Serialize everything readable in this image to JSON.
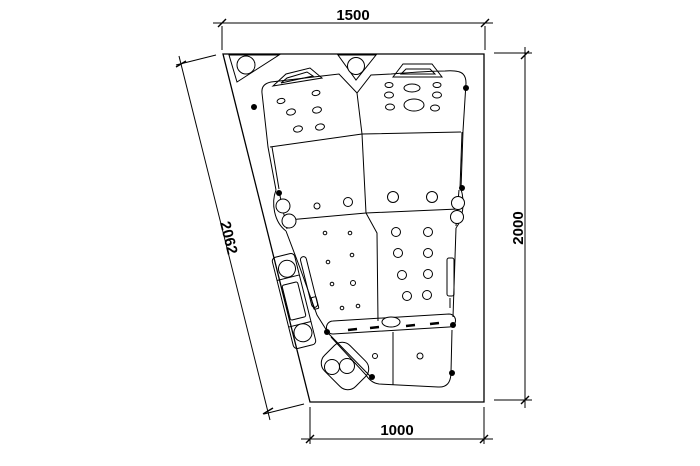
{
  "drawing": {
    "background": "#ffffff",
    "line_color": "#000000",
    "dimensions": {
      "top": "1500",
      "right": "2000",
      "bottom": "1000",
      "diagonal": "2062"
    }
  }
}
